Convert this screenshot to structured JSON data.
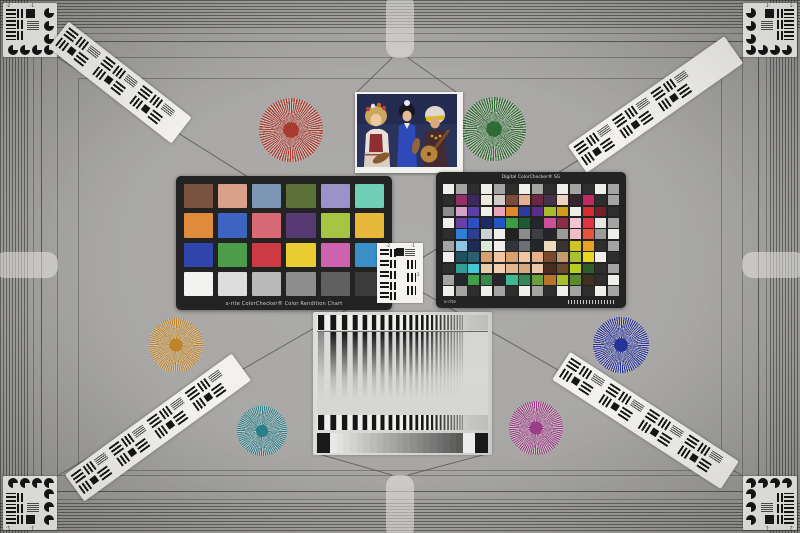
{
  "scene": {
    "name": "camera-resolution-color-test-chart"
  },
  "palette": {
    "background": "#a8a7a5",
    "hatch_line": "#4a4a48",
    "tab_highlight": "#eeedea",
    "card_white": "#f4f3f0",
    "chart_frame": "#232323",
    "diagonal_line": "#50504e",
    "star_gap": "#c6c3bf"
  },
  "classic_chart": {
    "label": "x-rite ColorChecker® Color Rendition Chart",
    "rows": 4,
    "cols": 6,
    "patches": [
      "#7a5240",
      "#d8a189",
      "#7e96b5",
      "#5b7138",
      "#9b93c8",
      "#6fcfb4",
      "#e08a3c",
      "#3d64c1",
      "#d96a75",
      "#573a74",
      "#a6c545",
      "#e8b83a",
      "#3146ad",
      "#4b9d4a",
      "#cc3a44",
      "#e8cc31",
      "#ce62ad",
      "#3a8fc8",
      "#f2f2f0",
      "#dddddd",
      "#b9b9b9",
      "#8d8d8d",
      "#606060",
      "#3c3c3c"
    ]
  },
  "sg_chart": {
    "title": "Digital ColorChecker® SG",
    "brand": "x-rite",
    "rows": 10,
    "cols": 14,
    "patches": [
      "#efeeea",
      "#a4a4a2",
      "#2e2e2e",
      "#efeeea",
      "#a4a4a2",
      "#2e2e2e",
      "#efeeea",
      "#a4a4a2",
      "#2e2e2e",
      "#efeeea",
      "#a4a4a2",
      "#2e2e2e",
      "#efeeea",
      "#a4a4a2",
      "#2e2e2e",
      "#953067",
      "#3c2a5c",
      "#efe9da",
      "#cfcecb",
      "#7c4b39",
      "#e6af94",
      "#6e2742",
      "#45334a",
      "#efd2c2",
      "#372430",
      "#c22a60",
      "#2e2e2e",
      "#a4a4a2",
      "#8c8c8a",
      "#d6a3c8",
      "#5940a8",
      "#efeeea",
      "#e9a4ba",
      "#e0862e",
      "#2c3c9c",
      "#5a2d88",
      "#a6bc2e",
      "#d09c1a",
      "#efeeea",
      "#d42c32",
      "#74202a",
      "#2e2e2e",
      "#efeeea",
      "#6a40a2",
      "#2c50c2",
      "#1c2a68",
      "#2256c8",
      "#3b9e40",
      "#1a5c30",
      "#24262b",
      "#cf4f9c",
      "#8f2b45",
      "#f0c6d0",
      "#df3440",
      "#e7e6e2",
      "#a4a4a2",
      "#2e2e2e",
      "#2e80d8",
      "#2b4090",
      "#ccd2d3",
      "#efeeea",
      "#222222",
      "#8c8c8a",
      "#3c4043",
      "#24262b",
      "#9b9b99",
      "#f2bcc6",
      "#e85238",
      "#9b9b99",
      "#efeeea",
      "#a4a4a2",
      "#8ec4e6",
      "#1d2b55",
      "#dbe7d7",
      "#efeeea",
      "#31343a",
      "#6b7076",
      "#24262b",
      "#eedcbe",
      "#3a3430",
      "#cfc522",
      "#e8a420",
      "#2e2e2e",
      "#a4a4a2",
      "#efeeea",
      "#20505e",
      "#2b6074",
      "#d8a06c",
      "#f2c6a0",
      "#d8a06c",
      "#f2c6a0",
      "#e8b088",
      "#7a4a2e",
      "#c89a70",
      "#aac22e",
      "#e8d822",
      "#efeeea",
      "#2e2e2e",
      "#2e2e2e",
      "#2e9e96",
      "#40c8d8",
      "#e8cba8",
      "#f0d0b0",
      "#e0b890",
      "#d8a980",
      "#eec6a8",
      "#4a2c1e",
      "#6b4a2e",
      "#b8cf22",
      "#2e5c2a",
      "#2e2e2e",
      "#a4a4a2",
      "#a4a4a2",
      "#24262b",
      "#3fa048",
      "#35894a",
      "#24262b",
      "#3fb892",
      "#2e8a52",
      "#6b9e3c",
      "#b8742e",
      "#a8bf2c",
      "#5c8a2e",
      "#43301c",
      "#2e2e2e",
      "#efeeea",
      "#efeeea",
      "#a4a4a2",
      "#2e2e2e",
      "#efeeea",
      "#a4a4a2",
      "#2e2e2e",
      "#efeeea",
      "#a4a4a2",
      "#2e2e2e",
      "#efeeea",
      "#a4a4a2",
      "#2e2e2e",
      "#efeeea",
      "#a4a4a2"
    ]
  },
  "siemens_stars": [
    {
      "name": "red",
      "x": 259,
      "y": 98,
      "d": 64,
      "color": "#a93a32"
    },
    {
      "name": "green",
      "x": 462,
      "y": 97,
      "d": 64,
      "color": "#2f6b35"
    },
    {
      "name": "orange",
      "x": 149,
      "y": 318,
      "d": 54,
      "color": "#c08428"
    },
    {
      "name": "blue",
      "x": 593,
      "y": 317,
      "d": 56,
      "color": "#27339b"
    },
    {
      "name": "teal",
      "x": 237,
      "y": 406,
      "d": 50,
      "color": "#297f8c"
    },
    {
      "name": "magenta",
      "x": 509,
      "y": 401,
      "d": 54,
      "color": "#9c3d88"
    }
  ],
  "resolution_strips": [
    {
      "name": "top-left",
      "cx": 117,
      "cy": 82,
      "len": 150,
      "angle": 38
    },
    {
      "name": "top-right",
      "cx": 652,
      "cy": 104,
      "len": 185,
      "angle": -35
    },
    {
      "name": "bottom-left",
      "cx": 155,
      "cy": 427,
      "len": 200,
      "angle": -36
    },
    {
      "name": "bottom-right",
      "cx": 642,
      "cy": 420,
      "len": 195,
      "angle": 33
    }
  ],
  "corner_targets": [
    {
      "name": "top-left",
      "x": 3,
      "y": 3,
      "sx": 1,
      "sy": 1
    },
    {
      "name": "top-right",
      "x": 743,
      "y": 3,
      "sx": -1,
      "sy": 1
    },
    {
      "name": "bottom-left",
      "x": 3,
      "y": 476,
      "sx": 1,
      "sy": -1
    },
    {
      "name": "bottom-right",
      "x": 743,
      "y": 476,
      "sx": -1,
      "sy": -1
    }
  ],
  "corner_labels": [
    "-2",
    "-1"
  ],
  "center_target": {
    "x": 377,
    "y": 243,
    "w": 46,
    "h": 60,
    "labels": [
      "-2",
      "-1",
      "2"
    ]
  },
  "gray_panel": {
    "x": 313,
    "y": 312,
    "w": 179,
    "h": 143,
    "sweep": {
      "start_width": 6.2,
      "ratio": 0.93
    },
    "wedge_steps": [
      "#e8e8e6",
      "#e1e1df",
      "#d9d9d7",
      "#d2d2d0",
      "#cacac8",
      "#c3c3c1",
      "#bbbbb9",
      "#b4b4b2",
      "#acacaa",
      "#a5a5a3",
      "#9d9d9b",
      "#969694",
      "#8e8e8c",
      "#878785",
      "#7f7f7d",
      "#787876",
      "#707070",
      "#696967",
      "#616160",
      "#5a5a58"
    ],
    "wedge_end_black": "#1a1a1a",
    "wedge_end_white": "#ececea"
  },
  "photo": {
    "name": "three-musicians-test-photo"
  }
}
